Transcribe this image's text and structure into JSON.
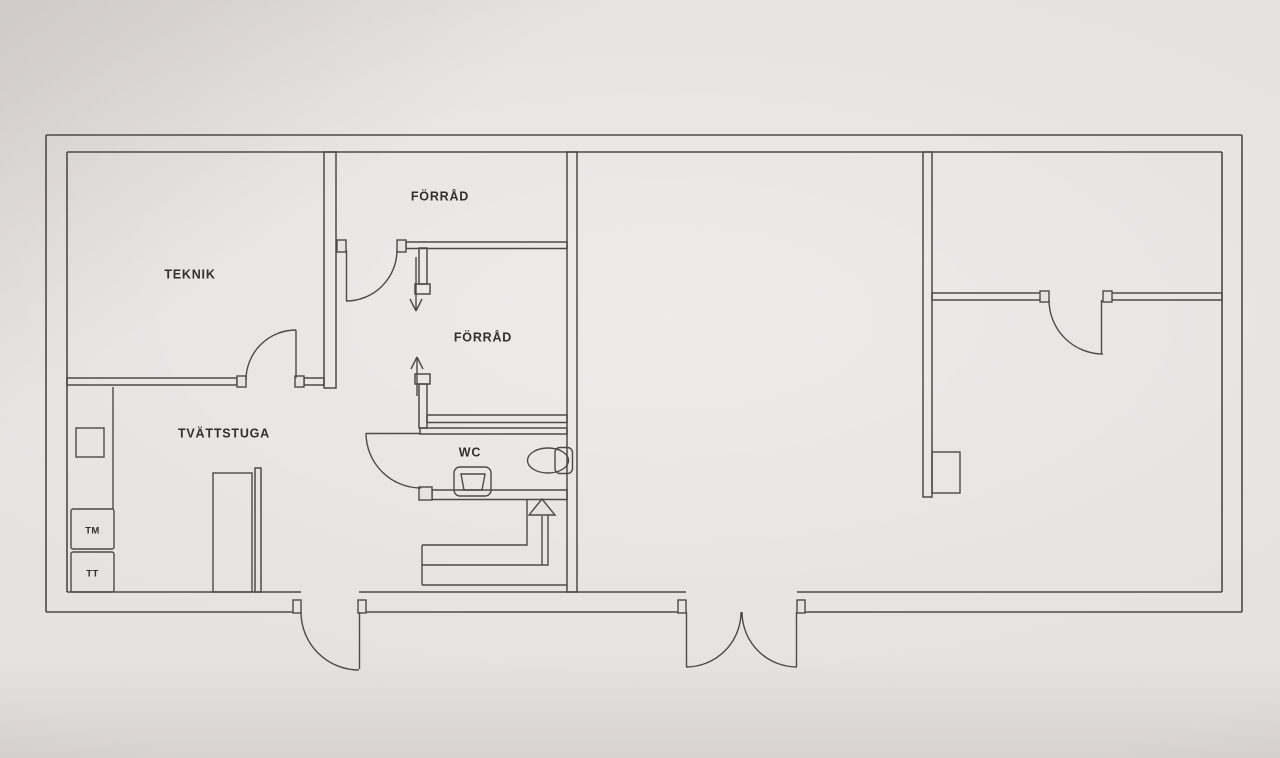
{
  "floorplan": {
    "rooms": [
      {
        "id": "teknik",
        "label": "TEKNIK"
      },
      {
        "id": "forrad_top",
        "label": "FÖRRÅD"
      },
      {
        "id": "forrad_middle",
        "label": "FÖRRÅD"
      },
      {
        "id": "tvattstuga",
        "label": "TVÄTTSTUGA"
      },
      {
        "id": "wc",
        "label": "WC"
      }
    ],
    "appliances": [
      {
        "id": "tm",
        "label": "TM"
      },
      {
        "id": "tt",
        "label": "TT"
      }
    ],
    "fixtures": [
      "toilet",
      "wash-basin",
      "laundry-sink",
      "counter",
      "bench",
      "pillar",
      "staircase",
      "stair-direction-arrow",
      "passage-arrow-down",
      "passage-arrow-up",
      "double-entry-door"
    ],
    "colors": {
      "paper": "#e7e3e1",
      "line": "#4f4a46",
      "text": "#332f2c"
    }
  }
}
